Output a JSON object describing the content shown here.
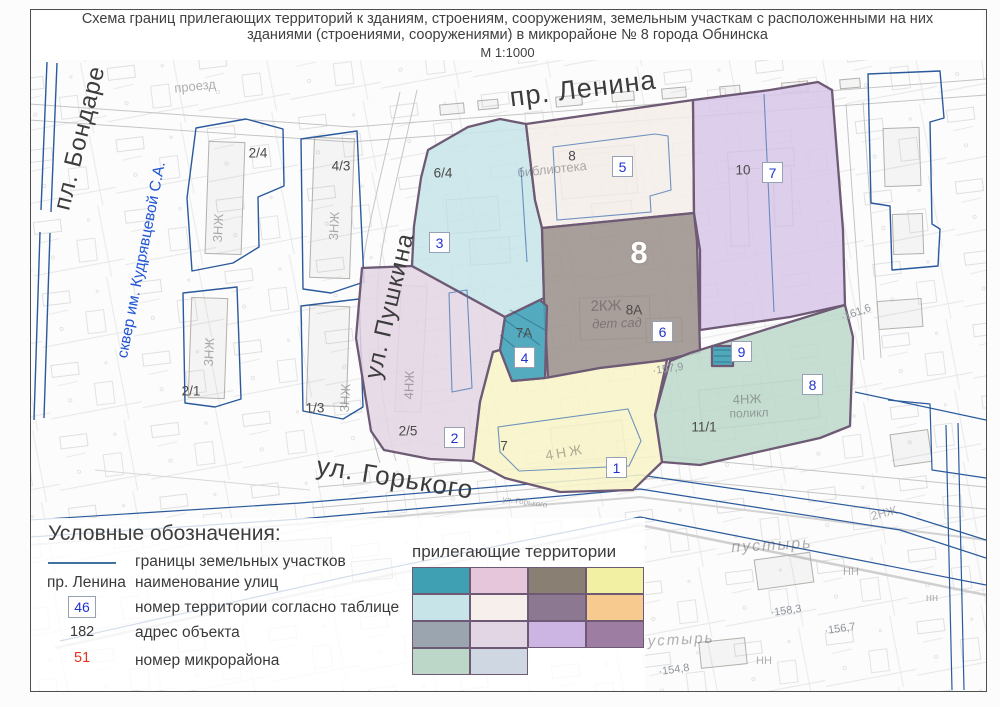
{
  "document": {
    "title_line1": "Схема границ прилегающих территорий к зданиям, строениям, сооружениям, земельным участкам с расположенными на них",
    "title_line2": "зданиями (строениями, сооружениями) в микрорайоне № 8 города Обнинска",
    "scale": "М 1:1000"
  },
  "map": {
    "streets": [
      {
        "name": "пр. Ленина"
      },
      {
        "name": "ул. Пушкина"
      },
      {
        "name": "ул. Горького"
      },
      {
        "name": "пл. Бондаре"
      },
      {
        "name": "сквер им. Кудрявцевой С.А."
      }
    ],
    "microdistrict_number": "8",
    "territory_markers": [
      "1",
      "2",
      "3",
      "4",
      "5",
      "6",
      "7",
      "8",
      "9"
    ],
    "address_labels": [
      "2/4",
      "4/3",
      "2/1",
      "1/3",
      "6/4",
      "8",
      "8А",
      "10",
      "2/5",
      "7",
      "11/1",
      "7А"
    ],
    "ghost_labels": [
      "проезд",
      "библиотека",
      "дет сад",
      "2КЖ",
      "4НЖ",
      "4НЖ",
      "4НЖ",
      "поликл",
      "3НЖ",
      "3НЖ",
      "3НЖ",
      "3НЖ",
      "2НЖ",
      "пустырь",
      "пустырь",
      "НН",
      "НН",
      "нн",
      "ул. Горького"
    ],
    "elevation_marks": [
      "·157,9",
      "·161,6",
      "·158,3",
      "·156,7",
      "·154,8"
    ],
    "zones": {
      "cyan": {
        "fill": "#c7e5e9"
      },
      "cream": {
        "fill": "#f5eee9"
      },
      "gray": {
        "fill": "#9b918c"
      },
      "purple": {
        "fill": "#d8c7e8"
      },
      "green": {
        "fill": "#bed8ca"
      },
      "yellow": {
        "fill": "#f8f5c8"
      },
      "pink": {
        "fill": "#e4d6e4"
      },
      "teal": {
        "fill": "#45a3b8"
      },
      "teal_square": {
        "fill": "#45a3b8"
      }
    }
  },
  "legend": {
    "heading": "Условные обозначения:",
    "items": [
      {
        "label": "границы земельных участков"
      },
      {
        "sample": "пр. Ленина",
        "label": "наименование улиц"
      },
      {
        "sample": "46",
        "label": "номер территории согласно таблице"
      },
      {
        "sample": "182",
        "label": "адрес объекта"
      },
      {
        "sample": "51",
        "label": "номер микрорайона"
      }
    ],
    "adjacent_title": "прилегающие территории",
    "swatches": [
      "#3fa0b4",
      "#e6c6da",
      "#8a7f73",
      "#f2f0a3",
      "#c7e5e9",
      "#f6efeb",
      "#8c7991",
      "#f7ca90",
      "#9aa5b0",
      "#e2d6e5",
      "#ccb4e3",
      "#9e7da3",
      "#bcd7c7",
      "#cfd7e3"
    ],
    "colors": {
      "boundary_line": "#41719c",
      "territory_number": "#2133cc",
      "microdistrict_number": "#e53322",
      "zone_border": "#6e5a74"
    }
  }
}
